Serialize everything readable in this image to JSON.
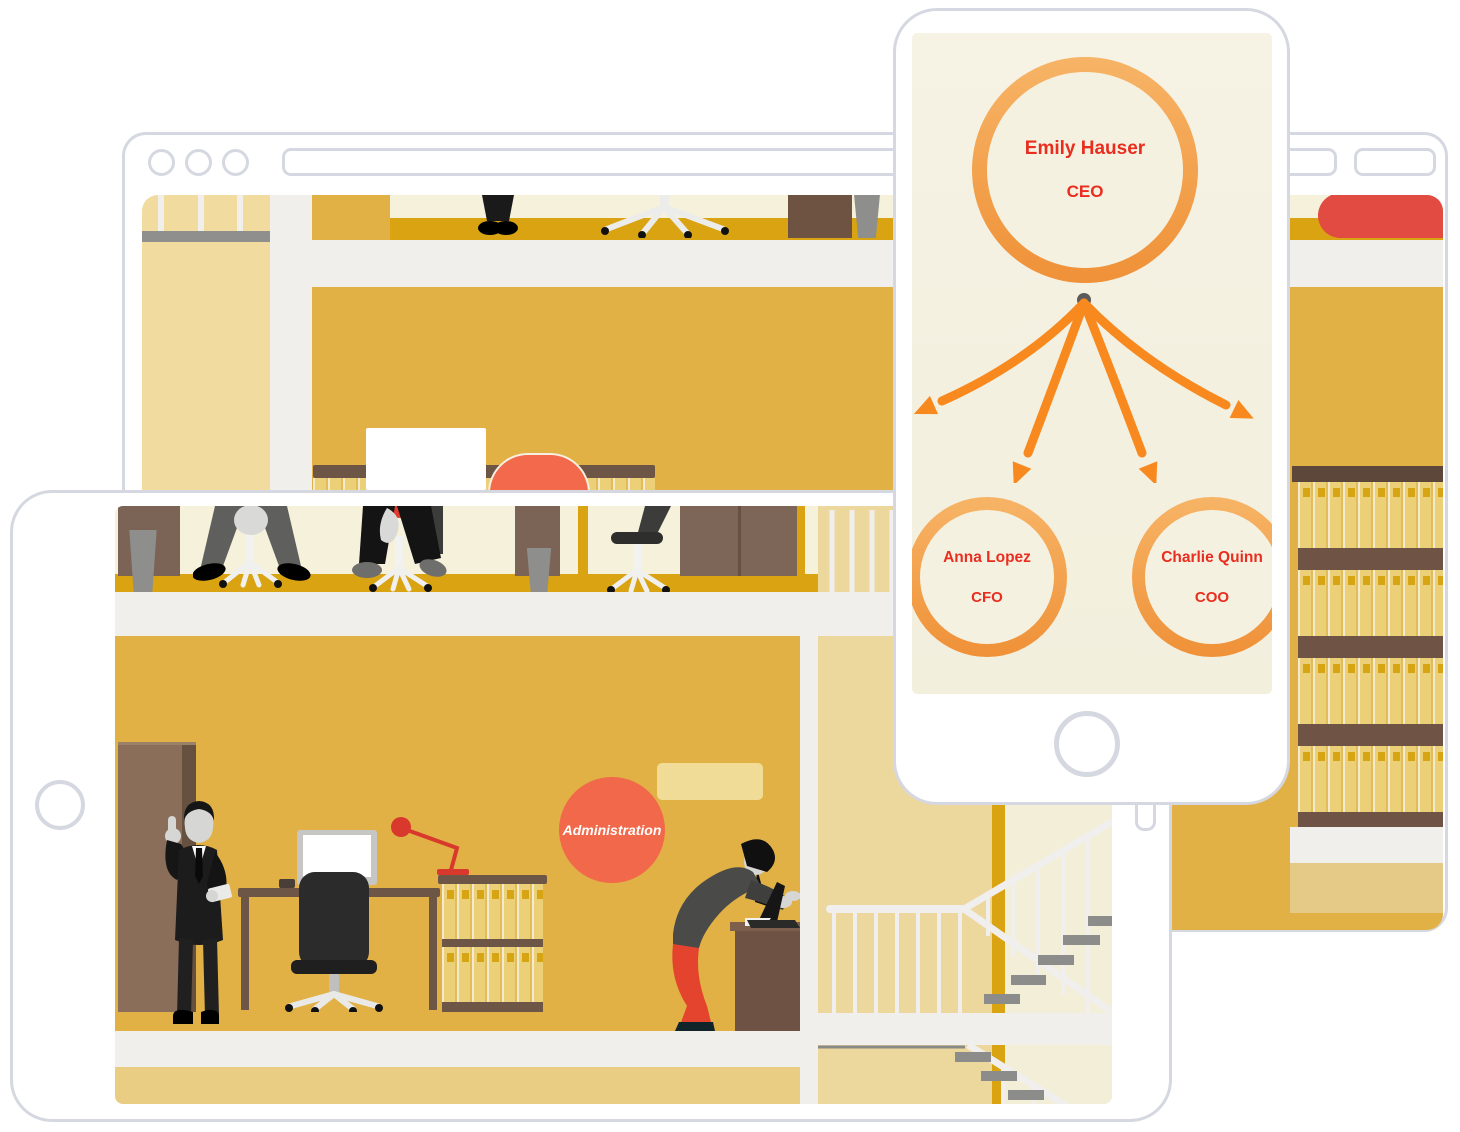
{
  "org_chart": {
    "type": "org-tree",
    "nodes": [
      {
        "name": "Emily Hauser",
        "title": "CEO"
      },
      {
        "name": "Anna Lopez",
        "title": "CFO"
      },
      {
        "name": "Charlie Quinn",
        "title": "COO"
      }
    ],
    "edges": [
      {
        "from": "Emily Hauser",
        "to": "Anna Lopez"
      },
      {
        "from": "Emily Hauser",
        "to": "Charlie Quinn"
      }
    ],
    "text_color": "#e92d1f",
    "ring_color": "#f2a04d",
    "arrow_color": "#f8891f",
    "screen_background": "#f5f1e1"
  },
  "office_scene": {
    "department_label": "Administration",
    "department_badge_color": "#f2684a",
    "wall_color": "#e1b145",
    "cream_wall_color": "#f6f1da",
    "baseboard_color": "#d9a312",
    "sofa_color": "#e14b41",
    "floor_slab_color": "#f0efec"
  },
  "devices": {
    "frame_color": "#d5d8e0"
  }
}
